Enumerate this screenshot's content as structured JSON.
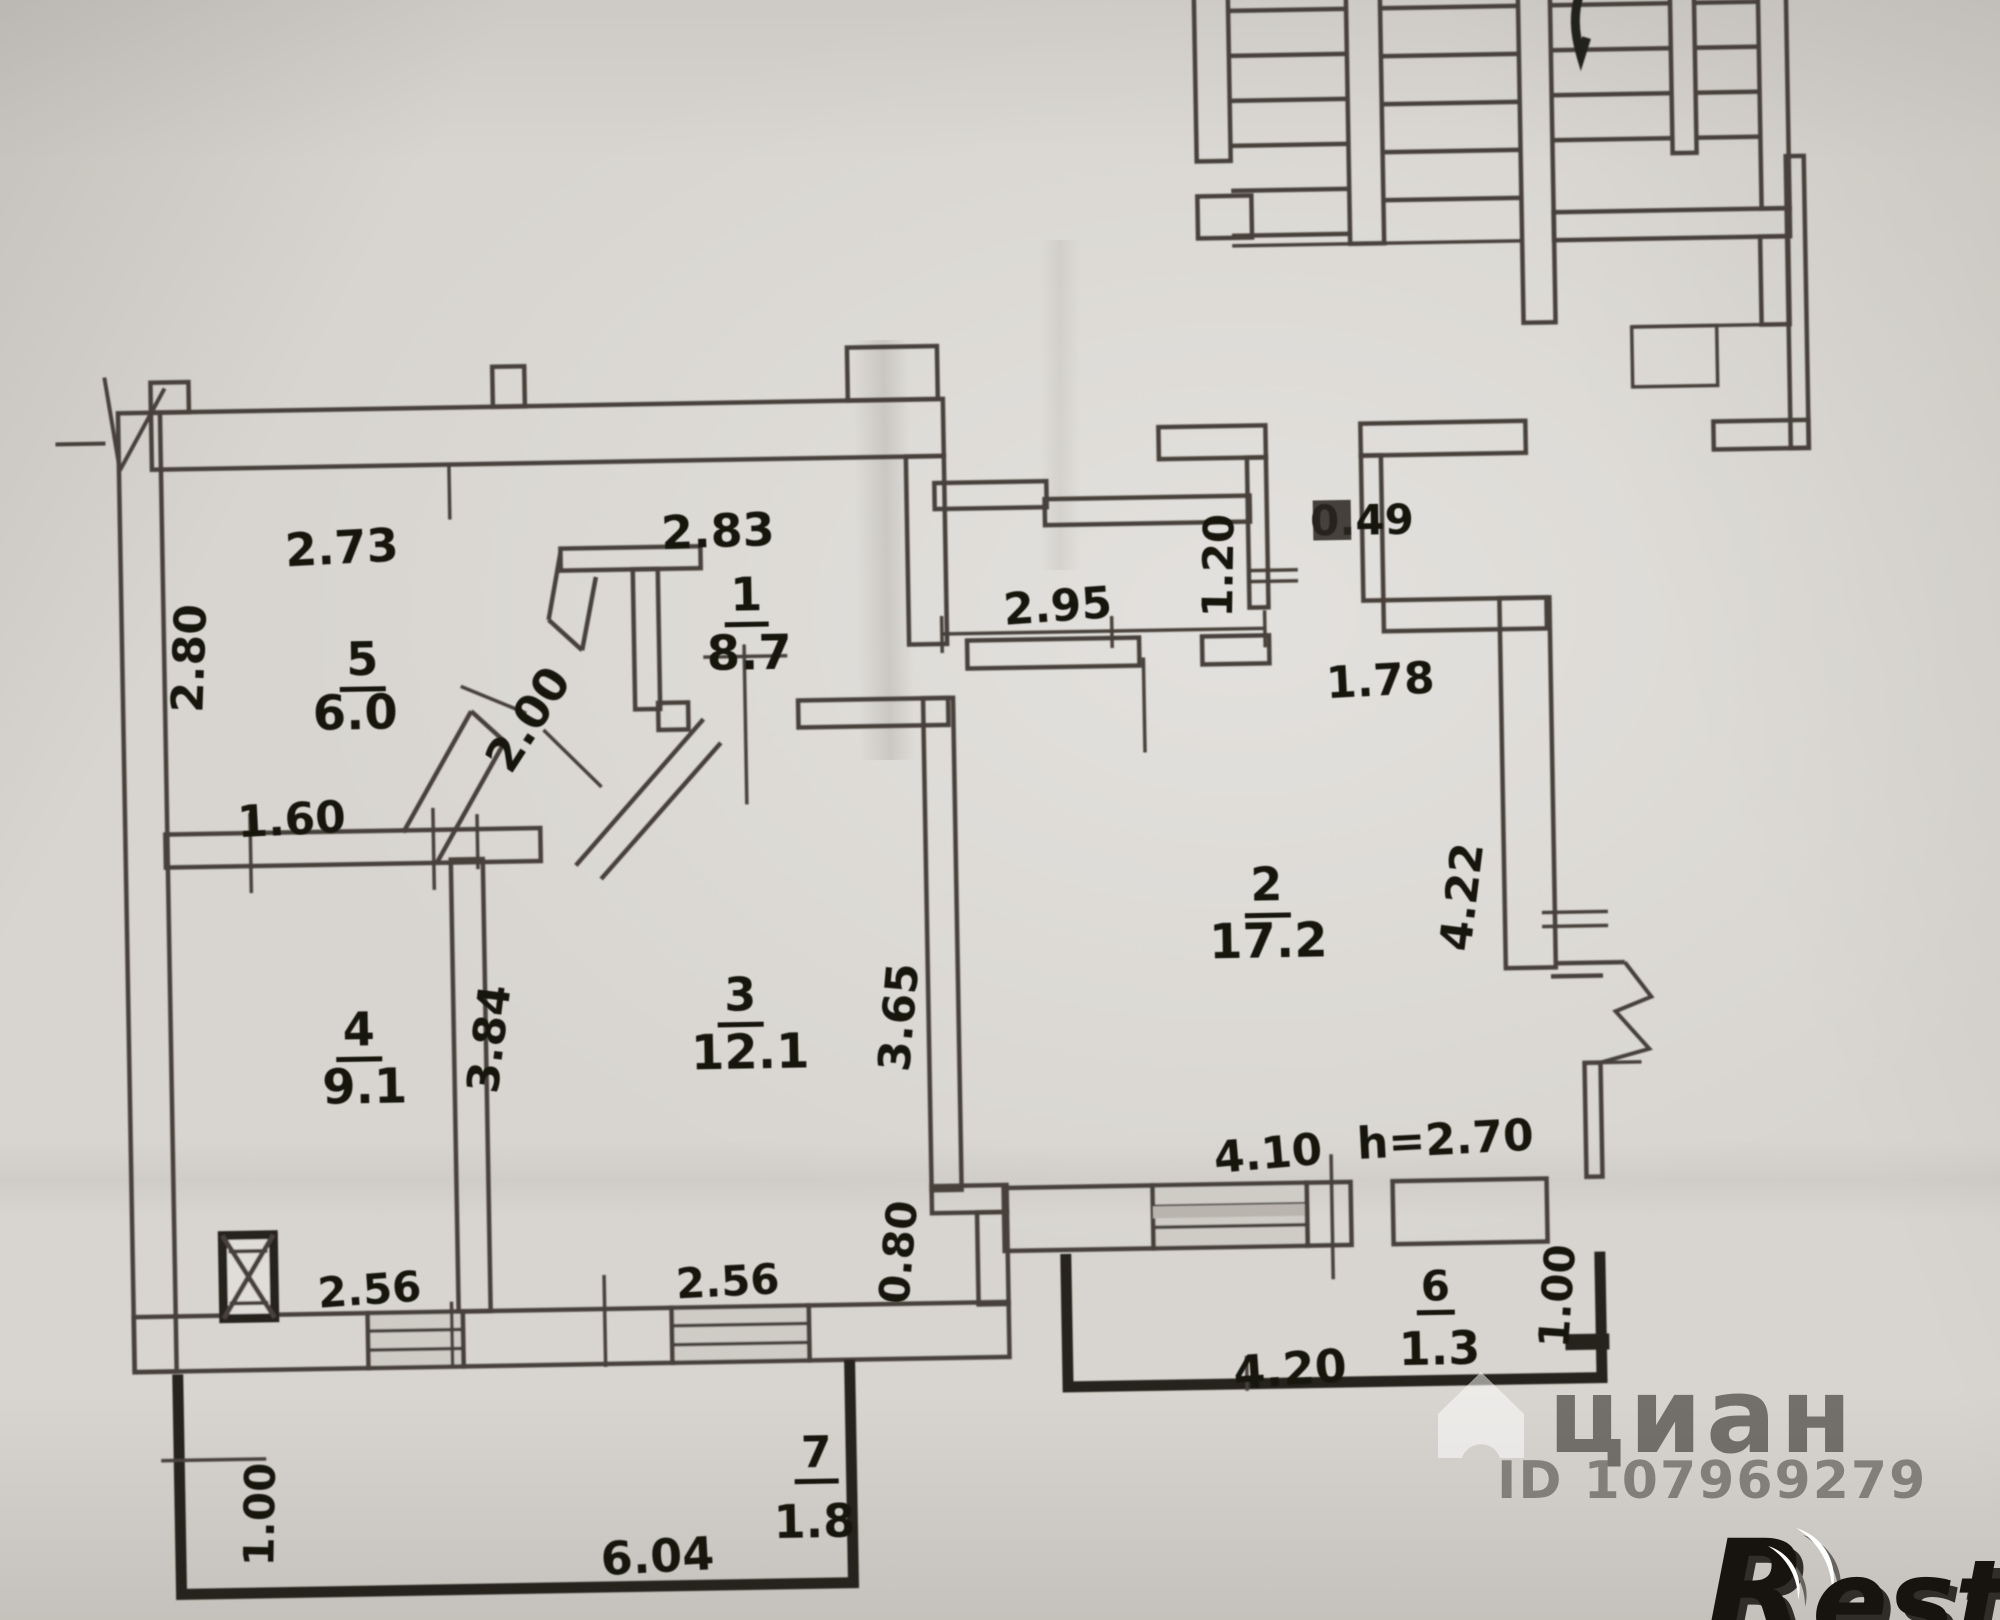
{
  "watermarks": {
    "cian": {
      "brand": "циан",
      "listing_id": "ID 107969279"
    },
    "restate": {
      "letter": "R",
      "rest": "estate"
    }
  },
  "rooms": [
    {
      "number": "1",
      "area": "8.7",
      "dims": {
        "top": "2.83"
      }
    },
    {
      "number": "2",
      "area": "17.2",
      "dims": {
        "top_left": "2.95",
        "entry_length": "1.20",
        "entry_width": "0.49",
        "top_right": "1.78",
        "right": "4.22",
        "bottom": "4.10",
        "ceiling_height": "h=2.70"
      }
    },
    {
      "number": "3",
      "area": "12.1",
      "dims": {
        "right": "3.65",
        "bottom": "2.56",
        "bottom_right": "0.80"
      }
    },
    {
      "number": "4",
      "area": "9.1",
      "dims": {
        "right": "3.84",
        "bottom": "2.56"
      }
    },
    {
      "number": "5",
      "area": "6.0",
      "dims": {
        "top": "2.73",
        "left": "2.80",
        "bottom": "1.60",
        "door": "2.00"
      }
    },
    {
      "number": "6",
      "area": "1.3",
      "dims": {
        "bottom": "4.20",
        "right": "1.00"
      }
    },
    {
      "number": "7",
      "area": "1.8",
      "dims": {
        "bottom": "6.04",
        "left": "1.00"
      }
    }
  ]
}
